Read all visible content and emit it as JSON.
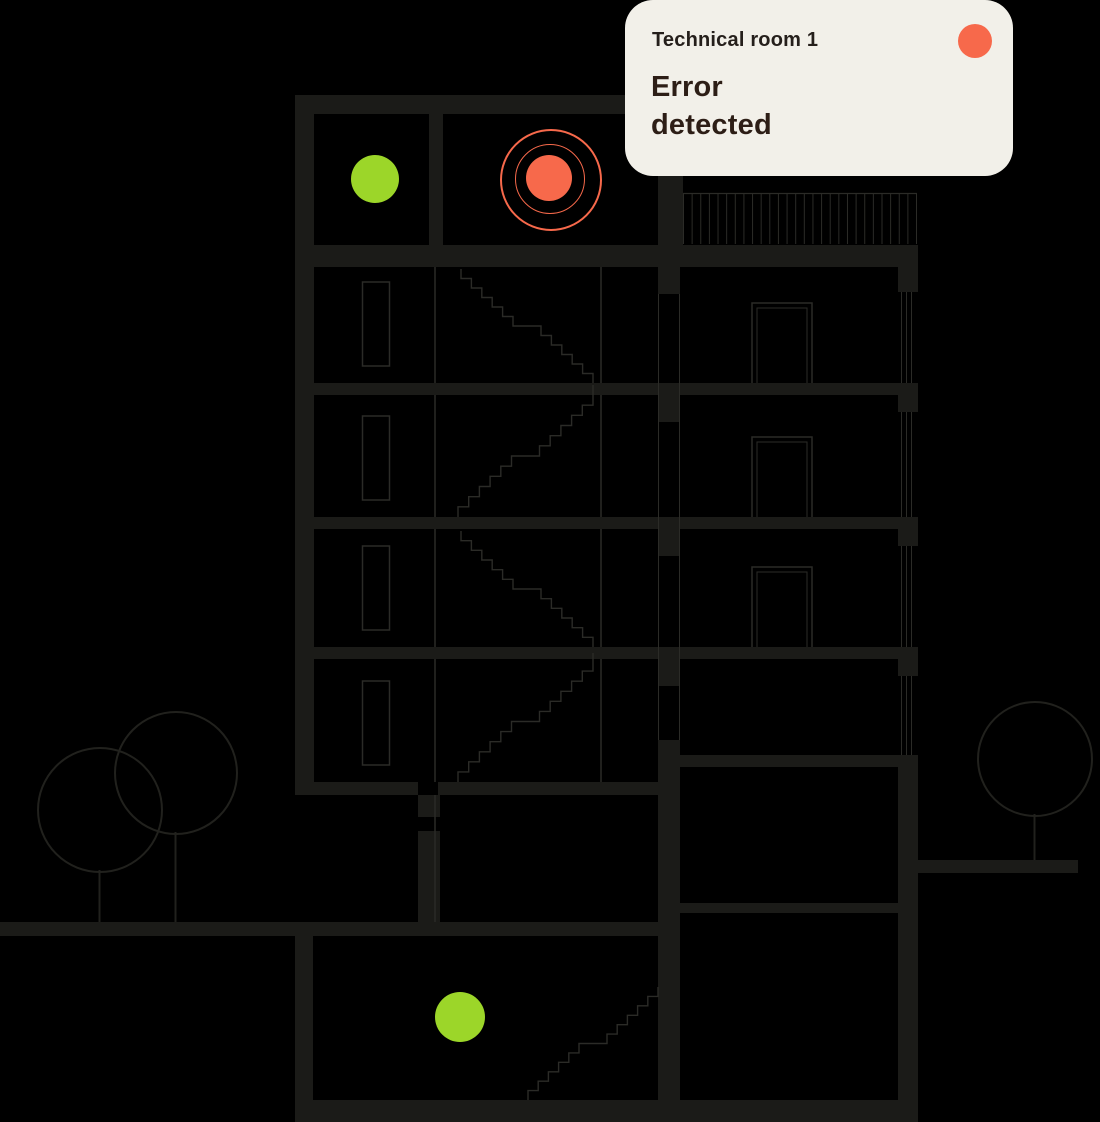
{
  "card": {
    "title": "Technical room 1",
    "message": "Error detected",
    "status": "error"
  },
  "indicators": [
    {
      "name": "top-floor-room-status",
      "state": "ok"
    },
    {
      "name": "technical-room-1-status",
      "state": "error"
    },
    {
      "name": "basement-room-status",
      "state": "ok"
    }
  ],
  "colors": {
    "background": "#000000",
    "wall": "#1B1B18",
    "line": "#2B2B27",
    "tree_line": "#21211D",
    "ok": "#9CD629",
    "error": "#F7694B",
    "card_bg": "#F2F0E9",
    "card_title": "#251F1B",
    "card_message": "#2D1E16"
  }
}
